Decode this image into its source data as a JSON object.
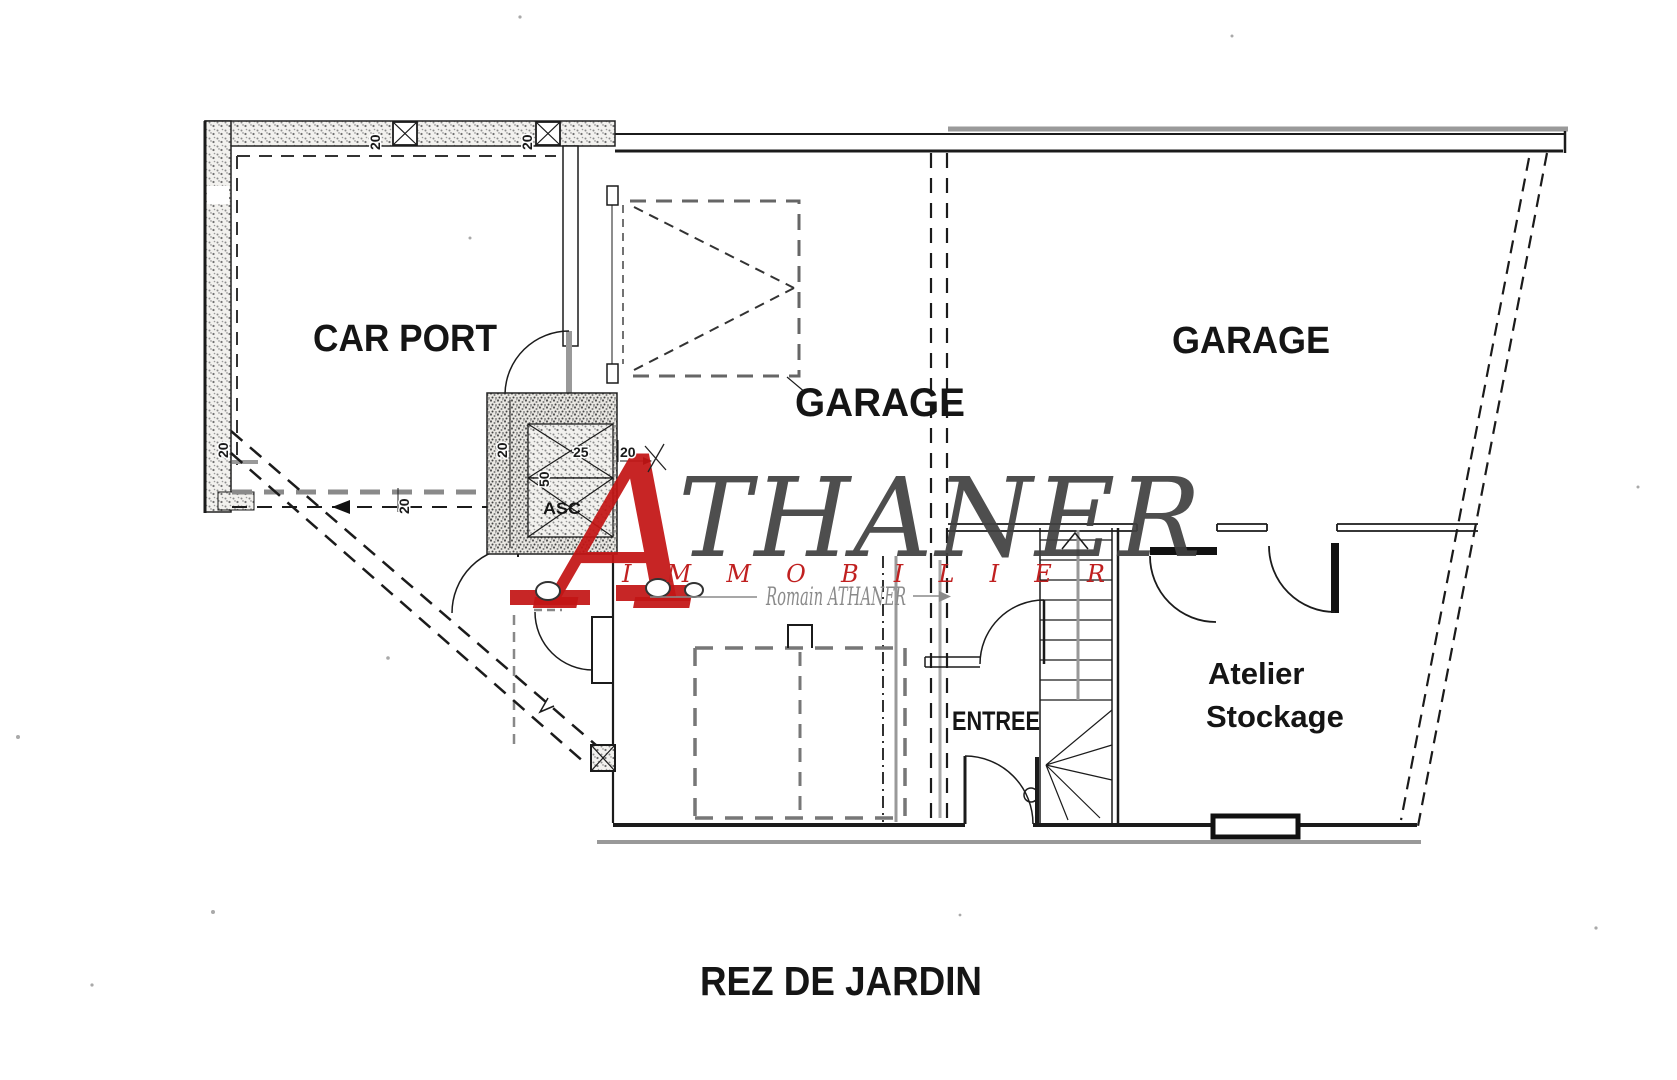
{
  "canvas": {
    "width": 1677,
    "height": 1080,
    "background": "#ffffff"
  },
  "plan": {
    "floor_title": "REZ DE JARDIN",
    "rooms": {
      "carport": {
        "label": "CAR PORT"
      },
      "garage_center": {
        "label": "GARAGE"
      },
      "garage_right": {
        "label": "GARAGE"
      },
      "entrance": {
        "label": "ENTREE"
      },
      "workshop_line1": "Atelier",
      "workshop_line2": "Stockage",
      "elevator": {
        "label": "ASC"
      }
    },
    "dimensions": {
      "twenty": "20",
      "twenty_five": "25",
      "fifty": "50"
    }
  },
  "watermark": {
    "initial": "A",
    "brand": "THANER",
    "tagline": "IMMOBILIER",
    "signature": "Romain ATHANER",
    "colors": {
      "red": "#c31515",
      "dark_gray": "#404040",
      "light_gray": "#8a8a8a"
    }
  }
}
